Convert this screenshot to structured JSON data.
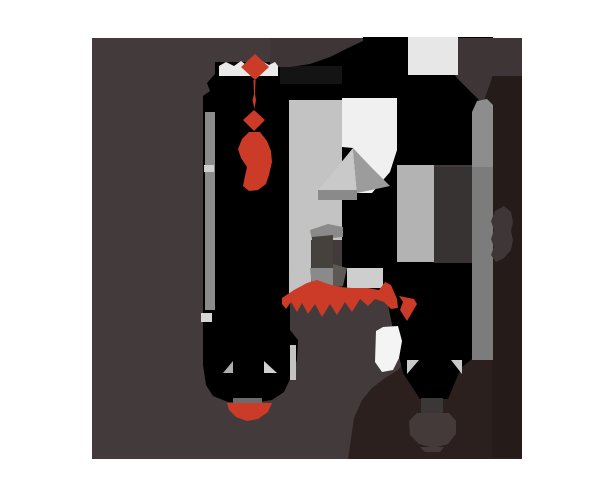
{
  "canvas": {
    "width": "614",
    "height": "498",
    "viewBox": "0 0 614 498",
    "background": "#ffffff",
    "label": "abstract-posterized-artwork"
  },
  "palette": {
    "background": "#ffffff",
    "main_brown": "#433b3b",
    "black": "#000000",
    "dark_maroon": "#251b18",
    "maroon_band": "#2b201e",
    "accent_red": "#cb3b28",
    "light_gray": "#c3c3c3",
    "off_white": "#f0f0f0",
    "mid_gray": "#8b8b8b"
  },
  "shapes": [
    {
      "name": "main-brown-field",
      "fill": "#433b3b",
      "points": "92,38 522,38 522,459 92,459"
    },
    {
      "name": "black-top-band",
      "fill": "#000000",
      "points": "215,66 270,66 270,60 363,40 363,37 408,37 408,130 215,130"
    },
    {
      "name": "black-left-column",
      "fill": "#000000",
      "points": "215,62 290,62 290,330 298,340 297,360 292,375 284,392 272,400 252,403 228,402 213,396 206,385 203,365 203,96 210,91 207,83 215,74"
    },
    {
      "name": "near-black-rect",
      "fill": "#141414",
      "points": "280,66 342,66 342,84 280,84"
    },
    {
      "name": "black-top-right-block",
      "fill": "#000000",
      "points": "397,37 493,37 493,165 397,165"
    },
    {
      "name": "black-center-block",
      "fill": "#000000",
      "points": "342,147 397,147 397,290 342,290"
    },
    {
      "name": "maroon-bottom-region",
      "fill": "#2b201e",
      "points": "348,459 354,418 362,400 372,388 385,378 398,370 404,362 425,357 450,353 475,350 522,348 522,459"
    },
    {
      "name": "black-center-bottom-block",
      "fill": "#000000",
      "points": "380,262 473,262 473,358 461,368 448,399 420,399 403,373 396,344 387,300 380,278"
    },
    {
      "name": "brown-blob-top-left",
      "fill": "#3e3636",
      "points": "270,38 363,38 363,41 348,48 330,57 310,64 290,67 270,67"
    },
    {
      "name": "brown-notch-top-right",
      "fill": "#3e3636",
      "points": "455,38 522,38 522,76 493,76 483,104 470,91 458,79 455,75"
    },
    {
      "name": "light-rect-top",
      "fill": "#e7e7e7",
      "points": "408,37 458,37 458,75 408,75"
    },
    {
      "name": "maroon-right-column",
      "fill": "#251b18",
      "points": "492,76 522,76 522,457 492,457"
    },
    {
      "name": "maroon-column-wedge",
      "fill": "#251b18",
      "points": "483,104 492,78 492,132"
    },
    {
      "name": "gray-column-upper",
      "fill": "#8d8d8d",
      "points": "472,112 477,101 487,99 493,105 493,167 472,167"
    },
    {
      "name": "gray-column-lower",
      "fill": "#7c7c7c",
      "points": "472,167 493,167 493,360 472,360"
    },
    {
      "name": "medium-gray-column",
      "fill": "#b3b3b3",
      "points": "397,165 434,165 434,262 397,262"
    },
    {
      "name": "dark-gray-column",
      "fill": "#373333",
      "points": "434,167 472,167 472,263 434,263"
    },
    {
      "name": "brown-oval-right",
      "fill": "#3f3737",
      "points": "495,211 504,206 511,212 513,222 511,231 513,240 511,250 504,258 496,262 491,255 494,247 491,239 494,230 491,221"
    },
    {
      "name": "lightgray-column",
      "fill": "#c3c3c3",
      "points": "289,100 342,100 342,240 311,240 311,302 289,302"
    },
    {
      "name": "white-rect-and-band",
      "fill": "#f0f0f0",
      "points": "342,98 397,98 397,150 390,172 372,193 357,193 353,148 342,147"
    },
    {
      "name": "triangle-light",
      "fill": "#c9c9c9",
      "points": "353,148 316,193 357,193"
    },
    {
      "name": "triangle-dark",
      "fill": "#9c9c9c",
      "points": "353,148 357,193 390,186 371,167"
    },
    {
      "name": "strip-under-triangle",
      "fill": "#8a8a8a",
      "points": "318,190 357,190 357,200 318,200"
    },
    {
      "name": "knuckle-wedge",
      "fill": "#8a8a8a",
      "points": "310,230 328,224 343,227 343,237 312,240"
    },
    {
      "name": "knuckle-rect",
      "fill": "#45413d",
      "points": "312,237 333,235 333,268 312,268"
    },
    {
      "name": "knuckle-quad",
      "fill": "#8a8a8a",
      "points": "310,268 333,268 333,286 312,288"
    },
    {
      "name": "knuckle-wedge-dark",
      "fill": "#5c5853",
      "points": "333,264 347,268 343,286 333,286"
    },
    {
      "name": "light-quad",
      "fill": "#cecece",
      "points": "347,268 383,268 383,288 347,288"
    },
    {
      "name": "gray-strip-vertical",
      "fill": "#8b8b8b",
      "points": "205,112 215,112 215,310 205,310"
    },
    {
      "name": "gray-strip-light-piece",
      "fill": "#d0d0d0",
      "points": "204,165 214,165 214,172 204,172"
    },
    {
      "name": "light-square-small",
      "fill": "#d6d6d6",
      "points": "201,313 212,313 212,322 201,322"
    },
    {
      "name": "white-collar",
      "fill": "#eaeaea",
      "points": "219,76 219,66 226,62 234,66 241,61 250,68 255,68 262,61 269,65 275,62 278,66 278,76"
    },
    {
      "name": "red-knot-diamond",
      "fill": "#cb3b28",
      "points": "255,54 269,67 255,80 241,67"
    },
    {
      "name": "red-thread",
      "fill": "#cb3b28",
      "points": "253.5,80 255.5,80 255,94 256,100 254.5,109 252.5,100 254,94"
    },
    {
      "name": "red-small-diamond",
      "fill": "#cb3b28",
      "points": "254,110 265,120 254,131 243,120"
    },
    {
      "name": "red-tie-blob",
      "fill": "#cb3b28",
      "points": "249,132 260,132 267,141 271,151 272,162 269,175 266,184 258,190 249,191 243,186 245,176 247,167 241,158 238,149 242,139"
    },
    {
      "name": "red-fringed-band",
      "fill": "#cb3b28",
      "points": "282,298 294,290 307,283 317,280 328,284 340,287 352,288 368,288 379,290 385,282 391,285 397,299 398,308 391,309 384,302 375,299 368,306 360,299 352,312 345,302 337,315 330,304 322,317 315,304 308,314 302,303 297,312 291,302 286,309 282,304"
    },
    {
      "name": "red-triangle-right",
      "fill": "#cb3b28",
      "points": "399,296 414,299 417,304 407,321 400,310 403,302"
    },
    {
      "name": "white-gap-band",
      "fill": "#f4f4f4",
      "points": "375,362 376,331 383,327 398,326 402,341 399,358 393,370 382,372"
    },
    {
      "name": "lightgray-strip-piece",
      "fill": "#c3c3c3",
      "points": "290,345 296,345 296,380 290,380"
    },
    {
      "name": "wedge-triangle-left-col",
      "fill": "#aeaeae",
      "points": "223,373 233,361 233,373"
    },
    {
      "name": "wedge-triangle-right-col",
      "fill": "#d0d0d0",
      "points": "264,361 277,373 264,373"
    },
    {
      "name": "gray-strip-horizontal",
      "fill": "#6b6b6b",
      "points": "233,398 262,398 262,405 233,405"
    },
    {
      "name": "red-dome",
      "fill": "#cb3b28",
      "points": "227,403 272,403 268,412 258,419 247,421 236,417 229,410"
    },
    {
      "name": "wedge-triangle-left-center",
      "fill": "#c9c9c9",
      "points": "407,360 419,360 407,374"
    },
    {
      "name": "wedge-triangle-right-center",
      "fill": "#c9c9c9",
      "points": "451,360 462,360 462,374"
    },
    {
      "name": "charcoal-rect",
      "fill": "#3b3737",
      "points": "421,398 443,398 443,415 421,415"
    },
    {
      "name": "brown-chin-blob",
      "fill": "#443a3a",
      "points": "409,421 417,413 449,413 456,421 456,434 448,444 434,448 419,444 410,435"
    },
    {
      "name": "brown-chin-feet",
      "fill": "#443a3a",
      "points": "420,447 444,447 440,452 425,452"
    }
  ]
}
